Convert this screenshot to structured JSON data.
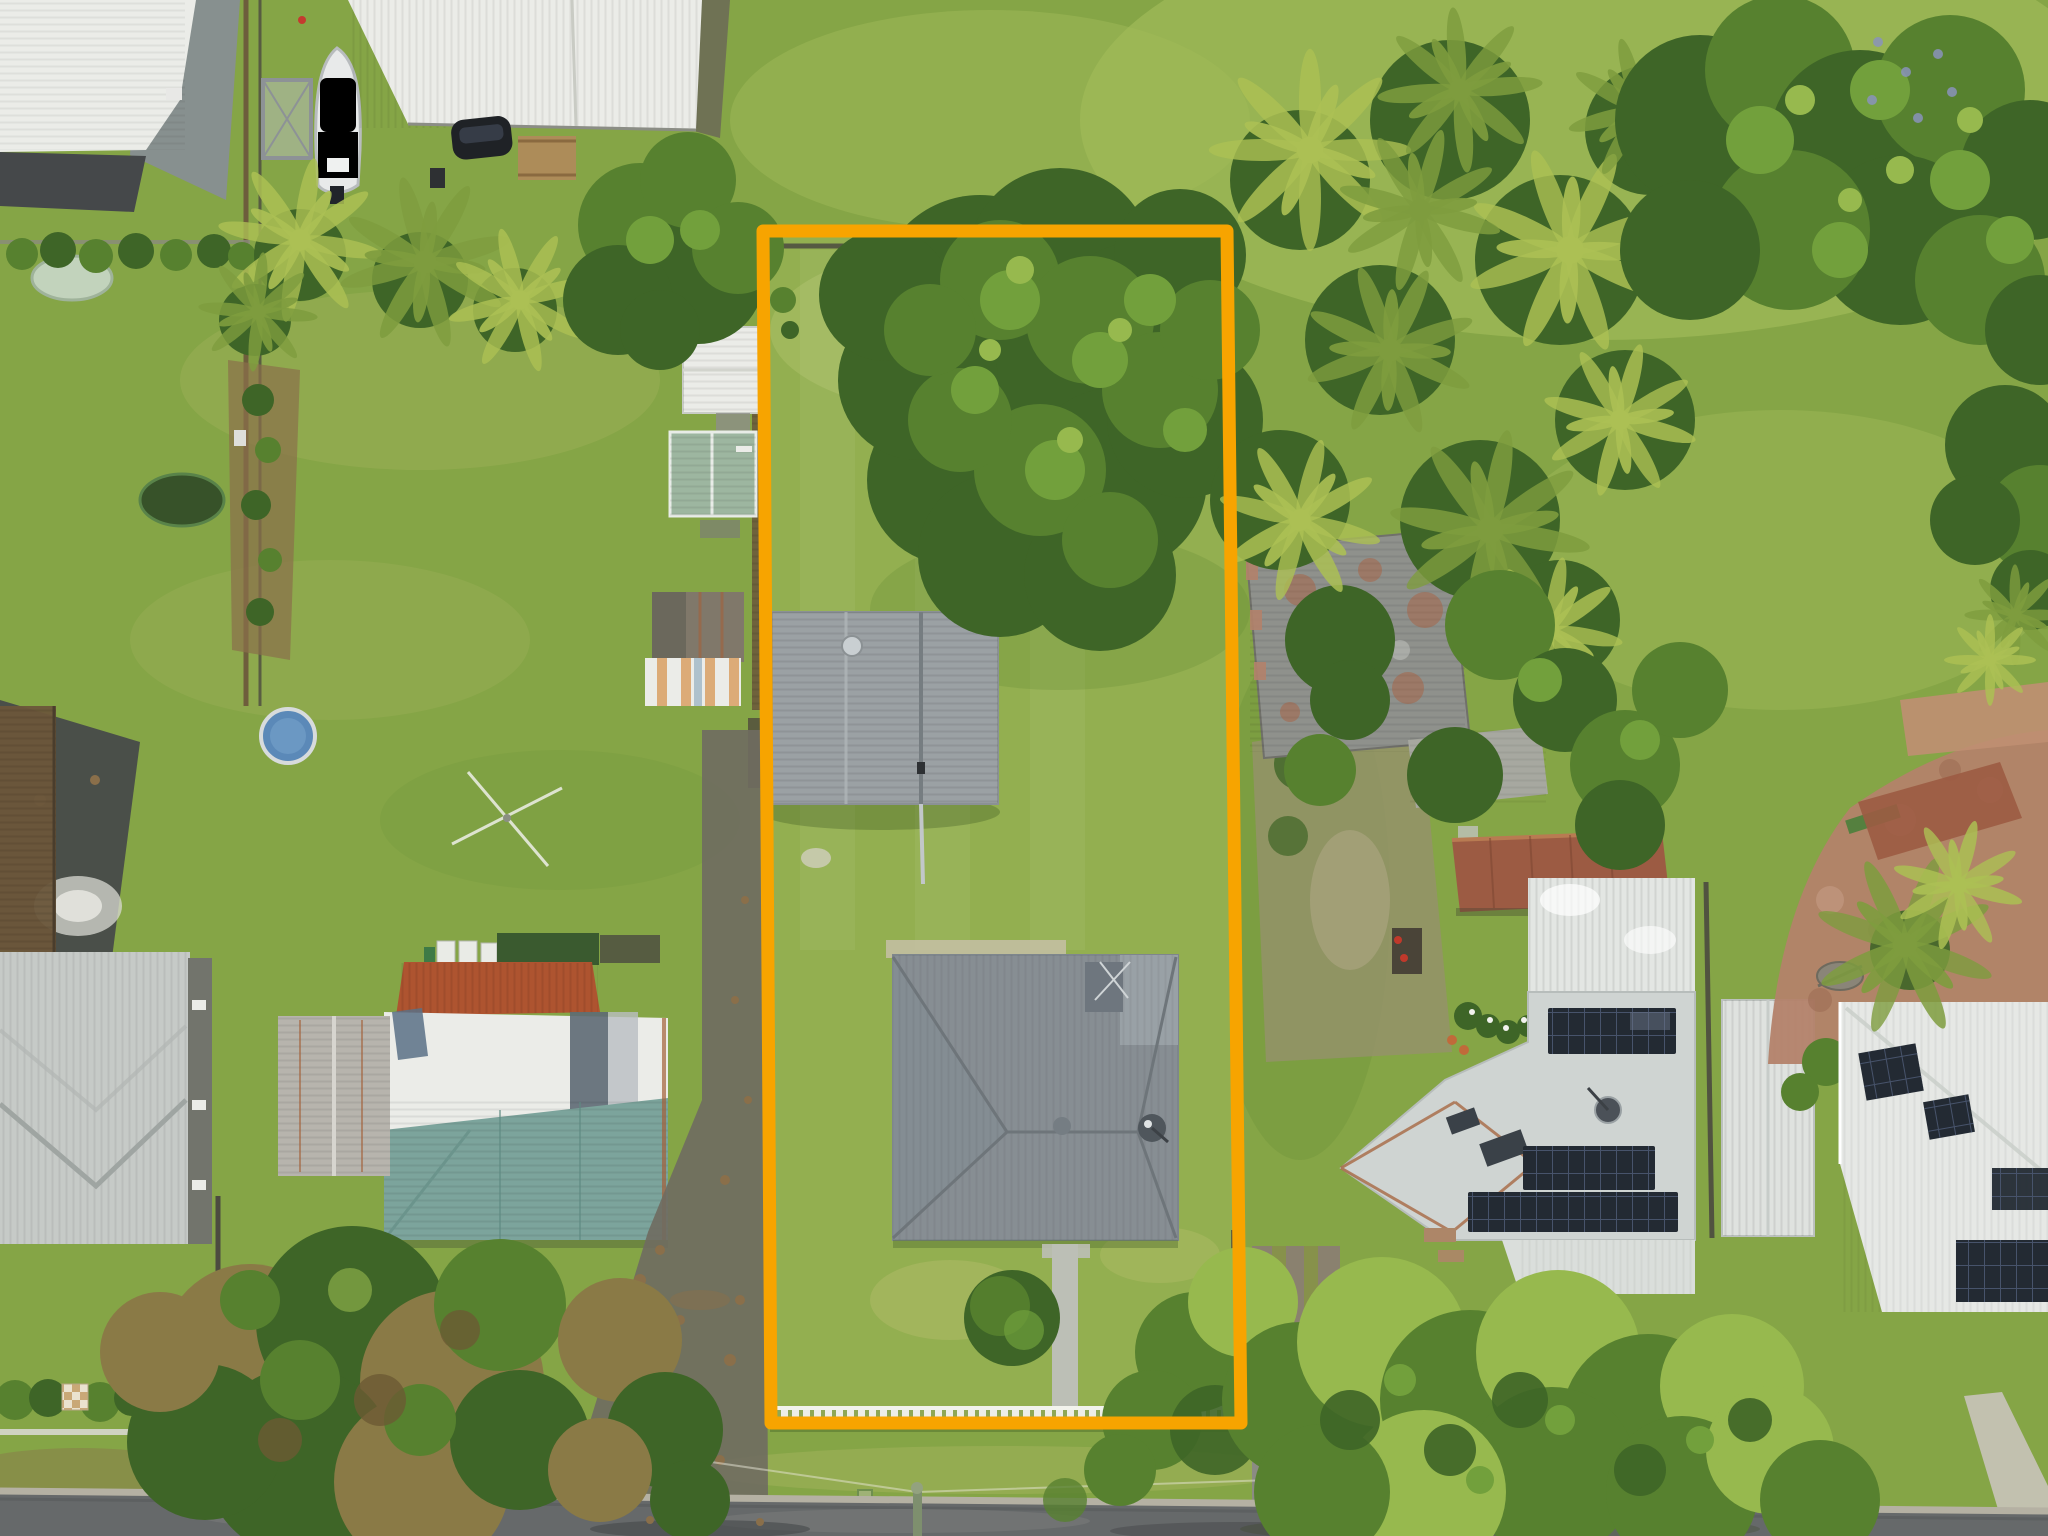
{
  "meta": {
    "title": "Aerial property photograph",
    "description": "Top-down drone photograph of a suburban block. An orange boundary overlay highlights a long rectangular lot containing a hip-roof house, a detached grey garage, a row of garden sheds along its left fence, a concrete front path, a round shrub and a white picket front fence. Neighbouring properties include a white-roof house and boat on a trailer at top left, a teal-and-white roof house and grey houses on the left, a weathered metal-roof cottage and two solar-panel houses on the right, a brick paver patio at far right, large tree canopies and palm clusters, and a bitumen street along the bottom edge."
  },
  "annotations": {
    "lot_boundary": {
      "label": "highlighted-lot-boundary",
      "shape": "polygon",
      "points": "763,231 1227,231 1241,1423 771,1423",
      "color": "#F7A400",
      "stroke_width": 13
    }
  },
  "palette": {
    "grass_base": "#85A546",
    "grass_light": "#9FBA58",
    "grass_dark": "#6A9038",
    "grass_lot": "#93AF50",
    "grass_pale": "#B9BF6E",
    "canopy_dark": "#3E6527",
    "canopy_mid": "#57812F",
    "canopy_light": "#72A03C",
    "canopy_bright": "#97B94E",
    "palm_light": "#ACC054",
    "palm_mid": "#7E9C3E",
    "olive_brown": "#8A7A46",
    "roof_white": "#EBECE8",
    "roof_light_gray": "#CFD4D2",
    "roof_gray": "#9BA1A4",
    "roof_dark_gray": "#878E93",
    "roof_teal": "#7CA49C",
    "roof_rust": "#AE5430",
    "rust_streak": "#A4613A",
    "roof_green_dark": "#3A5A2F",
    "solar_dark": "#232A33",
    "road_asphalt": "#66696A",
    "concrete": "#BCBFB6",
    "paver_brick": "#B3826A",
    "deck_brown": "#9C5B43",
    "timber_fence": "#6B563B",
    "fence_dark": "#4C4B40",
    "picket_white": "#EAEBE4",
    "boundary_orange": "#F7A400",
    "boat_blue": "#3B6BA5",
    "boat_dark": "#2C3B52",
    "dirt_brown": "#8A6F4A",
    "asphalt_dark": "#45484A",
    "car_dark": "#1F2226",
    "pond_green": "#C2D3BC",
    "pool_blue": "#5B89B8"
  },
  "scene": {
    "road": "suburban street along bottom edge",
    "lot_structures": [
      "main-house-hip-roof",
      "detached-garage",
      "garden-sheds-row",
      "white-picket-front-fence",
      "concrete-front-path",
      "round-shrub",
      "rear-timber-fence"
    ],
    "neighbors": [
      "corner-building-top-left",
      "boat-on-trailer",
      "white-roof-house-top",
      "teal-and-white-roof-house-left",
      "grey-gable-shed-left",
      "grey-roof-house-bottom-left",
      "weathered-metal-roof-house-right",
      "timber-deck-right",
      "solar-panel-house-right",
      "side-garage-right",
      "far-right-solar-house",
      "brick-paver-patio-far-right"
    ],
    "vegetation": [
      "large-canopy-over-lot",
      "palm-cluster-left",
      "palm-cluster-right",
      "top-right-canopy",
      "street-trees-bottom-left",
      "street-trees-bottom-right",
      "front-hedge-bottom-left"
    ],
    "details": [
      "clothesline",
      "above-ground-pool",
      "garden-pond",
      "burn-patch",
      "leaf-littered-driveway",
      "right-gravel-driveway",
      "power-pole",
      "letterbox"
    ]
  }
}
